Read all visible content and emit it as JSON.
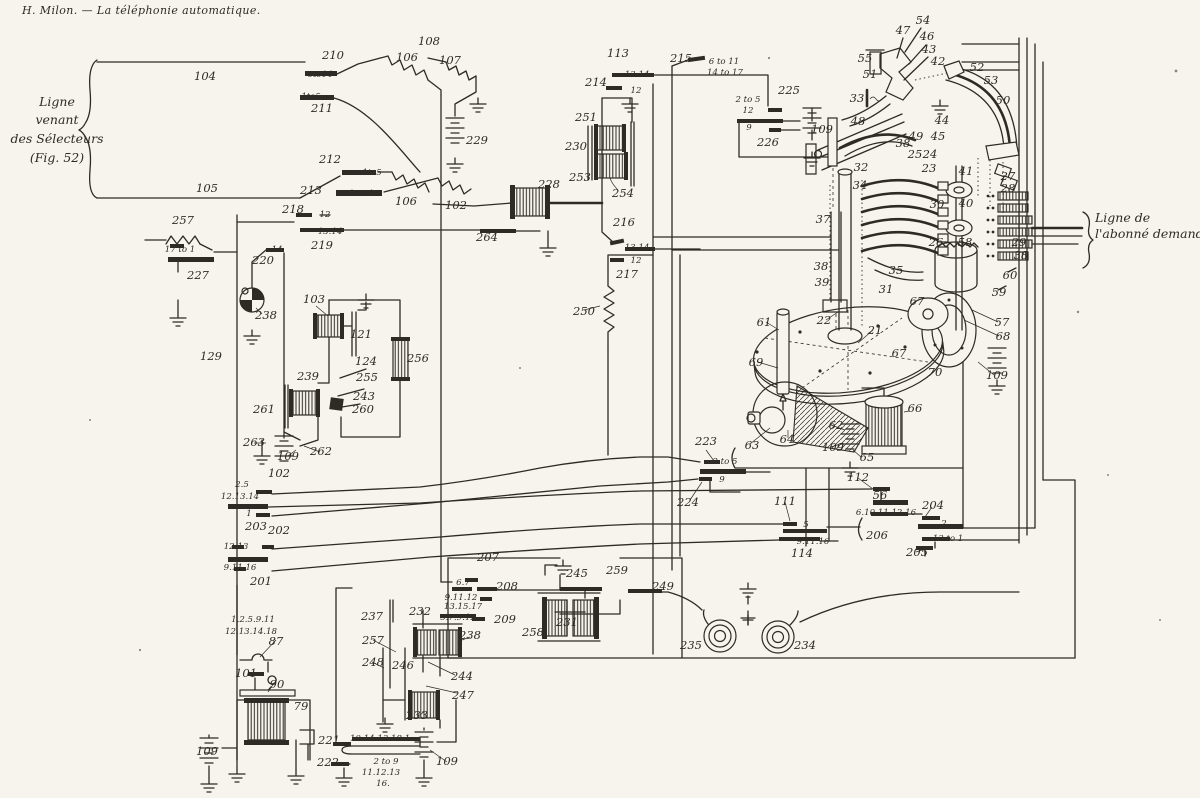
{
  "page": {
    "header": "H. Milon. — La téléphonie automatique.",
    "left_line_label": {
      "lines": [
        "Ligne",
        "venant",
        "des Sélecteurs",
        "(Fig. 52)"
      ]
    },
    "right_line_label": {
      "lines": [
        "Ligne de",
        "l'abonné demandé"
      ]
    }
  },
  "diagram": {
    "ink_color": "#2e2b26",
    "paper_color": "#f6f4ec",
    "labels": [
      {
        "t": "104",
        "x": 205,
        "y": 80,
        "s": 1
      },
      {
        "t": "210",
        "x": 333,
        "y": 59,
        "s": 1
      },
      {
        "t": "6to14",
        "x": 320,
        "y": 77,
        "s": 0
      },
      {
        "t": "1to5",
        "x": 311,
        "y": 99,
        "s": 0
      },
      {
        "t": "211",
        "x": 322,
        "y": 112,
        "s": 1
      },
      {
        "t": "212",
        "x": 330,
        "y": 163,
        "s": 1
      },
      {
        "t": "1to5",
        "x": 372,
        "y": 175,
        "s": 0
      },
      {
        "t": "105",
        "x": 207,
        "y": 192,
        "s": 1
      },
      {
        "t": "213",
        "x": 311,
        "y": 194,
        "s": 1
      },
      {
        "t": "15to18",
        "x": 364,
        "y": 196,
        "s": 0
      },
      {
        "t": "108",
        "x": 429,
        "y": 45,
        "s": 1
      },
      {
        "t": "106",
        "x": 407,
        "y": 61,
        "s": 1
      },
      {
        "t": "107",
        "x": 450,
        "y": 64,
        "s": 1
      },
      {
        "t": "229",
        "x": 477,
        "y": 144,
        "s": 1
      },
      {
        "t": "106",
        "x": 406,
        "y": 205,
        "s": 1
      },
      {
        "t": "102",
        "x": 456,
        "y": 209,
        "s": 1
      },
      {
        "t": "228",
        "x": 549,
        "y": 188,
        "s": 1
      },
      {
        "t": "264",
        "x": 487,
        "y": 241,
        "s": 1
      },
      {
        "t": "113",
        "x": 618,
        "y": 57,
        "s": 1
      },
      {
        "t": "13.14",
        "x": 637,
        "y": 77,
        "s": 0
      },
      {
        "t": "214",
        "x": 596,
        "y": 86,
        "s": 1
      },
      {
        "t": "12",
        "x": 636,
        "y": 93,
        "s": 0
      },
      {
        "t": "251",
        "x": 586,
        "y": 121,
        "s": 1
      },
      {
        "t": "230",
        "x": 576,
        "y": 150,
        "s": 1
      },
      {
        "t": "253",
        "x": 580,
        "y": 181,
        "s": 1
      },
      {
        "t": "254",
        "x": 623,
        "y": 197,
        "s": 1
      },
      {
        "t": "216",
        "x": 624,
        "y": 226,
        "s": 1
      },
      {
        "t": "13.14",
        "x": 637,
        "y": 250,
        "s": 0
      },
      {
        "t": "12",
        "x": 636,
        "y": 263,
        "s": 0
      },
      {
        "t": "217",
        "x": 627,
        "y": 278,
        "s": 1
      },
      {
        "t": "215",
        "x": 681,
        "y": 62,
        "s": 1
      },
      {
        "t": "6 to 11",
        "x": 724,
        "y": 64,
        "s": 0
      },
      {
        "t": "14 to 17",
        "x": 725,
        "y": 75,
        "s": 0
      },
      {
        "t": "2 to 5",
        "x": 748,
        "y": 102,
        "s": 0
      },
      {
        "t": "12",
        "x": 748,
        "y": 113,
        "s": 0
      },
      {
        "t": "225",
        "x": 789,
        "y": 94,
        "s": 1
      },
      {
        "t": "9",
        "x": 749,
        "y": 130,
        "s": 0
      },
      {
        "t": "226",
        "x": 768,
        "y": 146,
        "s": 1
      },
      {
        "t": "109",
        "x": 822,
        "y": 133,
        "s": 1
      },
      {
        "t": "54",
        "x": 923,
        "y": 24,
        "s": 1
      },
      {
        "t": "47",
        "x": 903,
        "y": 34,
        "s": 1
      },
      {
        "t": "46",
        "x": 927,
        "y": 40,
        "s": 1
      },
      {
        "t": "43",
        "x": 929,
        "y": 53,
        "s": 1
      },
      {
        "t": "42",
        "x": 938,
        "y": 65,
        "s": 1
      },
      {
        "t": "52",
        "x": 977,
        "y": 71,
        "s": 1
      },
      {
        "t": "53",
        "x": 991,
        "y": 84,
        "s": 1
      },
      {
        "t": "50",
        "x": 1003,
        "y": 104,
        "s": 1
      },
      {
        "t": "55",
        "x": 865,
        "y": 62,
        "s": 1
      },
      {
        "t": "51",
        "x": 870,
        "y": 78,
        "s": 1
      },
      {
        "t": "33",
        "x": 857,
        "y": 102,
        "s": 1
      },
      {
        "t": "48",
        "x": 858,
        "y": 125,
        "s": 1
      },
      {
        "t": "44",
        "x": 942,
        "y": 124,
        "s": 1
      },
      {
        "t": "49",
        "x": 916,
        "y": 140,
        "s": 1
      },
      {
        "t": "45",
        "x": 938,
        "y": 140,
        "s": 1
      },
      {
        "t": "38",
        "x": 903,
        "y": 147,
        "s": 1
      },
      {
        "t": "25",
        "x": 915,
        "y": 158,
        "s": 1
      },
      {
        "t": "24",
        "x": 930,
        "y": 158,
        "s": 1
      },
      {
        "t": "23",
        "x": 929,
        "y": 172,
        "s": 1
      },
      {
        "t": "41",
        "x": 966,
        "y": 175,
        "s": 1
      },
      {
        "t": "27",
        "x": 1008,
        "y": 180,
        "s": 1
      },
      {
        "t": "28",
        "x": 1008,
        "y": 192,
        "s": 1
      },
      {
        "t": "30",
        "x": 937,
        "y": 208,
        "s": 1
      },
      {
        "t": "40",
        "x": 966,
        "y": 207,
        "s": 1
      },
      {
        "t": "32",
        "x": 861,
        "y": 171,
        "s": 1
      },
      {
        "t": "34",
        "x": 860,
        "y": 189,
        "s": 1
      },
      {
        "t": "37",
        "x": 823,
        "y": 223,
        "s": 1
      },
      {
        "t": "26",
        "x": 936,
        "y": 246,
        "s": 1
      },
      {
        "t": "58",
        "x": 965,
        "y": 246,
        "s": 1
      },
      {
        "t": "29",
        "x": 1019,
        "y": 246,
        "s": 1
      },
      {
        "t": "38",
        "x": 1021,
        "y": 259,
        "s": 1
      },
      {
        "t": "60",
        "x": 1010,
        "y": 279,
        "s": 1
      },
      {
        "t": "59",
        "x": 999,
        "y": 296,
        "s": 1
      },
      {
        "t": "57",
        "x": 1002,
        "y": 326,
        "s": 1
      },
      {
        "t": "68",
        "x": 1003,
        "y": 340,
        "s": 1
      },
      {
        "t": "109",
        "x": 997,
        "y": 379,
        "s": 1
      },
      {
        "t": "35",
        "x": 896,
        "y": 274,
        "s": 1
      },
      {
        "t": "31",
        "x": 886,
        "y": 293,
        "s": 1
      },
      {
        "t": "38",
        "x": 821,
        "y": 270,
        "s": 1
      },
      {
        "t": "39",
        "x": 822,
        "y": 286,
        "s": 1
      },
      {
        "t": "22",
        "x": 824,
        "y": 324,
        "s": 1
      },
      {
        "t": "21",
        "x": 875,
        "y": 334,
        "s": 1
      },
      {
        "t": "67",
        "x": 917,
        "y": 305,
        "s": 1
      },
      {
        "t": "67",
        "x": 899,
        "y": 357,
        "s": 1
      },
      {
        "t": "70",
        "x": 935,
        "y": 376,
        "s": 1
      },
      {
        "t": "61",
        "x": 764,
        "y": 326,
        "s": 1
      },
      {
        "t": "69",
        "x": 756,
        "y": 366,
        "s": 1
      },
      {
        "t": "63",
        "x": 752,
        "y": 449,
        "s": 1
      },
      {
        "t": "64",
        "x": 787,
        "y": 443,
        "s": 1
      },
      {
        "t": "62",
        "x": 836,
        "y": 429,
        "s": 1
      },
      {
        "t": "109",
        "x": 833,
        "y": 451,
        "s": 1
      },
      {
        "t": "65",
        "x": 867,
        "y": 461,
        "s": 1
      },
      {
        "t": "66",
        "x": 915,
        "y": 412,
        "s": 1
      },
      {
        "t": "257",
        "x": 183,
        "y": 224,
        "s": 1
      },
      {
        "t": "17 to 1",
        "x": 180,
        "y": 252,
        "s": 0
      },
      {
        "t": "227",
        "x": 198,
        "y": 279,
        "s": 1
      },
      {
        "t": "218",
        "x": 293,
        "y": 213,
        "s": 1
      },
      {
        "t": "12",
        "x": 325,
        "y": 217,
        "s": 0
      },
      {
        "t": "13.14",
        "x": 330,
        "y": 234,
        "s": 0
      },
      {
        "t": "219",
        "x": 322,
        "y": 249,
        "s": 1
      },
      {
        "t": "14",
        "x": 277,
        "y": 252,
        "s": 0
      },
      {
        "t": "220",
        "x": 263,
        "y": 264,
        "s": 1
      },
      {
        "t": "238",
        "x": 266,
        "y": 319,
        "s": 1
      },
      {
        "t": "103",
        "x": 314,
        "y": 303,
        "s": 1
      },
      {
        "t": "121",
        "x": 361,
        "y": 338,
        "s": 1
      },
      {
        "t": "124",
        "x": 366,
        "y": 365,
        "s": 1
      },
      {
        "t": "255",
        "x": 367,
        "y": 381,
        "s": 1
      },
      {
        "t": "243",
        "x": 364,
        "y": 400,
        "s": 1
      },
      {
        "t": "260",
        "x": 363,
        "y": 413,
        "s": 1
      },
      {
        "t": "256",
        "x": 418,
        "y": 362,
        "s": 1
      },
      {
        "t": "239",
        "x": 308,
        "y": 380,
        "s": 1
      },
      {
        "t": "261",
        "x": 264,
        "y": 413,
        "s": 1
      },
      {
        "t": "263",
        "x": 254,
        "y": 446,
        "s": 1
      },
      {
        "t": "109",
        "x": 288,
        "y": 460,
        "s": 1
      },
      {
        "t": "262",
        "x": 321,
        "y": 455,
        "s": 1
      },
      {
        "t": "102",
        "x": 279,
        "y": 477,
        "s": 1
      },
      {
        "t": "129",
        "x": 211,
        "y": 360,
        "s": 1
      },
      {
        "t": "2.5",
        "x": 242,
        "y": 487,
        "s": 0
      },
      {
        "t": "12.13.14",
        "x": 240,
        "y": 499,
        "s": 0
      },
      {
        "t": "1",
        "x": 249,
        "y": 516,
        "s": 0
      },
      {
        "t": "203",
        "x": 256,
        "y": 530,
        "s": 1
      },
      {
        "t": "202",
        "x": 279,
        "y": 534,
        "s": 1
      },
      {
        "t": "12.13",
        "x": 236,
        "y": 549,
        "s": 0
      },
      {
        "t": "9.11.16",
        "x": 240,
        "y": 570,
        "s": 0
      },
      {
        "t": "201",
        "x": 261,
        "y": 585,
        "s": 1
      },
      {
        "t": "1.2.5.9.11",
        "x": 253,
        "y": 622,
        "s": 0
      },
      {
        "t": "12.13.14.18",
        "x": 251,
        "y": 634,
        "s": 0
      },
      {
        "t": "87",
        "x": 276,
        "y": 645,
        "s": 1
      },
      {
        "t": "101",
        "x": 246,
        "y": 677,
        "s": 1
      },
      {
        "t": "90",
        "x": 277,
        "y": 688,
        "s": 1
      },
      {
        "t": "79",
        "x": 301,
        "y": 710,
        "s": 1
      },
      {
        "t": "109",
        "x": 207,
        "y": 755,
        "s": 1
      },
      {
        "t": "221",
        "x": 329,
        "y": 744,
        "s": 1
      },
      {
        "t": "10.14.13.18.1",
        "x": 380,
        "y": 741,
        "s": 0
      },
      {
        "t": "222",
        "x": 328,
        "y": 766,
        "s": 1
      },
      {
        "t": "2 to 9",
        "x": 386,
        "y": 764,
        "s": 0
      },
      {
        "t": "11.12.13",
        "x": 381,
        "y": 775,
        "s": 0
      },
      {
        "t": "16.",
        "x": 383,
        "y": 786,
        "s": 0
      },
      {
        "t": "109",
        "x": 447,
        "y": 765,
        "s": 1
      },
      {
        "t": "237",
        "x": 372,
        "y": 620,
        "s": 1
      },
      {
        "t": "232",
        "x": 420,
        "y": 615,
        "s": 1
      },
      {
        "t": "257",
        "x": 373,
        "y": 644,
        "s": 1
      },
      {
        "t": "248",
        "x": 373,
        "y": 666,
        "s": 1
      },
      {
        "t": "246",
        "x": 403,
        "y": 669,
        "s": 1
      },
      {
        "t": "244",
        "x": 462,
        "y": 680,
        "s": 1
      },
      {
        "t": "247",
        "x": 463,
        "y": 699,
        "s": 1
      },
      {
        "t": "233",
        "x": 417,
        "y": 719,
        "s": 1
      },
      {
        "t": "238",
        "x": 470,
        "y": 639,
        "s": 1
      },
      {
        "t": "207",
        "x": 488,
        "y": 561,
        "s": 1
      },
      {
        "t": "6.7",
        "x": 463,
        "y": 585,
        "s": 0
      },
      {
        "t": "208",
        "x": 507,
        "y": 590,
        "s": 1
      },
      {
        "t": "9.11.12",
        "x": 461,
        "y": 600,
        "s": 0
      },
      {
        "t": "13.15.17",
        "x": 463,
        "y": 609,
        "s": 0
      },
      {
        "t": "5.7.9.12",
        "x": 458,
        "y": 620,
        "s": 0
      },
      {
        "t": "209",
        "x": 505,
        "y": 623,
        "s": 1
      },
      {
        "t": "258",
        "x": 533,
        "y": 636,
        "s": 1
      },
      {
        "t": "231",
        "x": 567,
        "y": 626,
        "s": 1
      },
      {
        "t": "245",
        "x": 577,
        "y": 577,
        "s": 1
      },
      {
        "t": "259",
        "x": 617,
        "y": 574,
        "s": 1
      },
      {
        "t": "249",
        "x": 663,
        "y": 590,
        "s": 1
      },
      {
        "t": "235",
        "x": 691,
        "y": 649,
        "s": 1
      },
      {
        "t": "234",
        "x": 805,
        "y": 649,
        "s": 1
      },
      {
        "t": "250",
        "x": 584,
        "y": 315,
        "s": 1
      },
      {
        "t": "223",
        "x": 706,
        "y": 445,
        "s": 1
      },
      {
        "t": "2 to 5",
        "x": 725,
        "y": 464,
        "s": 0
      },
      {
        "t": "9",
        "x": 722,
        "y": 482,
        "s": 0
      },
      {
        "t": "224",
        "x": 688,
        "y": 506,
        "s": 1
      },
      {
        "t": "111",
        "x": 785,
        "y": 505,
        "s": 1
      },
      {
        "t": "5",
        "x": 806,
        "y": 527,
        "s": 0
      },
      {
        "t": "9.11.16",
        "x": 813,
        "y": 544,
        "s": 0
      },
      {
        "t": "114",
        "x": 802,
        "y": 557,
        "s": 1
      },
      {
        "t": "112",
        "x": 858,
        "y": 481,
        "s": 1
      },
      {
        "t": "56",
        "x": 880,
        "y": 499,
        "s": 1
      },
      {
        "t": "6.10.11.12.16",
        "x": 886,
        "y": 515,
        "s": 0
      },
      {
        "t": "206",
        "x": 877,
        "y": 539,
        "s": 1
      },
      {
        "t": "204",
        "x": 933,
        "y": 509,
        "s": 1
      },
      {
        "t": "2",
        "x": 944,
        "y": 526,
        "s": 0
      },
      {
        "t": "13 to 1",
        "x": 948,
        "y": 541,
        "s": 0
      },
      {
        "t": "205",
        "x": 917,
        "y": 556,
        "s": 1
      }
    ]
  }
}
